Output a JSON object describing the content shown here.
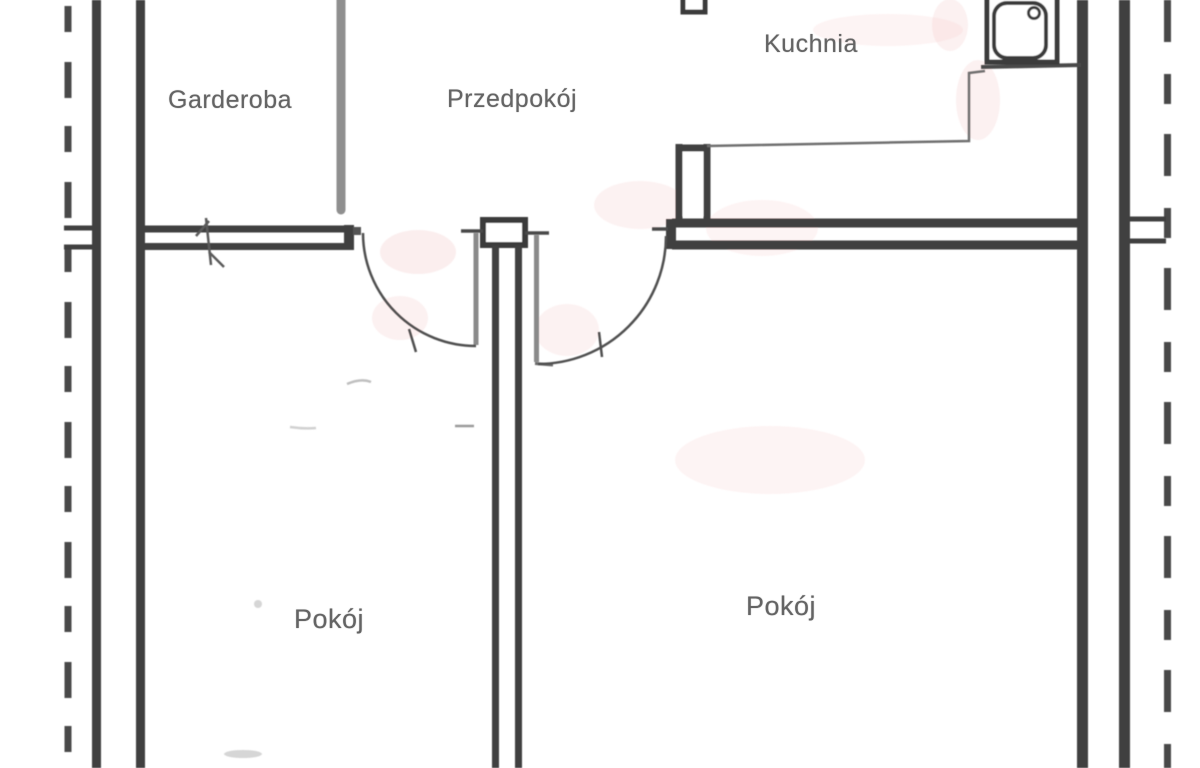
{
  "plan": {
    "rooms": [
      {
        "id": "garderoba",
        "label": "Garderoba"
      },
      {
        "id": "przedpokoj",
        "label": "Przedpokój"
      },
      {
        "id": "kuchnia",
        "label": "Kuchnia"
      },
      {
        "id": "pokoj-left",
        "label": "Pokój"
      },
      {
        "id": "pokoj-right",
        "label": "Pokój"
      }
    ],
    "fixtures": [
      {
        "id": "kitchen-sink",
        "icon": "kitchen-sink-icon"
      }
    ],
    "symbols": [
      {
        "id": "door-swing-left-room",
        "icon": "door-arc-icon"
      },
      {
        "id": "door-swing-right-room",
        "icon": "door-arc-icon"
      },
      {
        "id": "window-break-mark",
        "icon": "wall-break-icon"
      }
    ],
    "colors": {
      "wall": "#3f3f3f",
      "light_wall": "#8f8f8f",
      "thin_line": "#6f6f6f",
      "text": "#646464",
      "background": "#ffffff",
      "scan_tint": "#ecaaa8"
    }
  }
}
